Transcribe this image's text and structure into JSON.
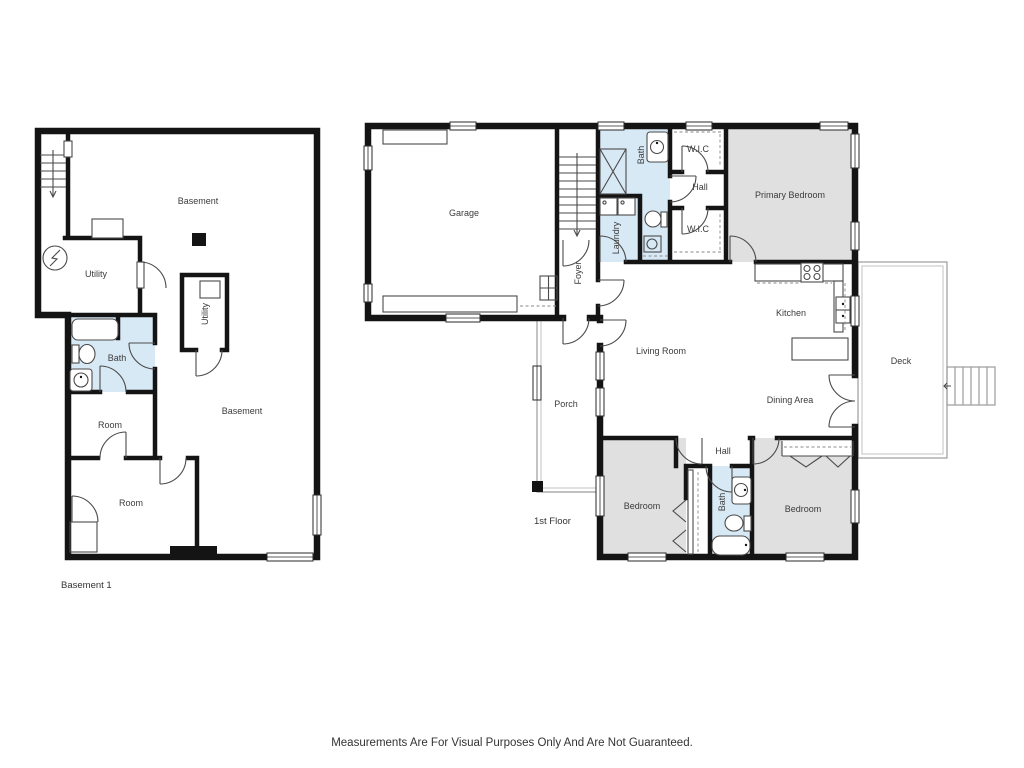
{
  "page": {
    "background": "#ffffff",
    "caption": "Measurements Are For Visual Purposes Only And Are Not Guaranteed."
  },
  "colors": {
    "wall": "#141414",
    "wet_room_fill": "#d8e9f6",
    "bedroom_fill": "#e0e0e0",
    "fixture_stroke": "#4a4a4a",
    "porch_deck_outline": "#9b9b9b",
    "label_text": "#3b3b3b"
  },
  "basement_floor": {
    "title": "Basement 1",
    "rooms": {
      "basement_main": "Basement",
      "utility": "Utility",
      "bath": "Bath",
      "utility_closet": "Utility",
      "basement_lower": "Basement",
      "room_upper": "Room",
      "room_lower": "Room"
    }
  },
  "first_floor": {
    "title": "1st Floor",
    "rooms": {
      "garage": "Garage",
      "bath_upper": "Bath",
      "wic_upper": "W.I.C",
      "hall_upper": "Hall",
      "wic_lower": "W.I.C",
      "laundry": "Laundry",
      "foyer": "Foyer",
      "primary_bedroom": "Primary Bedroom",
      "kitchen": "Kitchen",
      "living_room": "Living Room",
      "dining_area": "Dining Area",
      "deck": "Deck",
      "porch": "Porch",
      "hall_lower": "Hall",
      "bedroom_left": "Bedroom",
      "bath_lower": "Bath",
      "bedroom_right": "Bedroom"
    }
  }
}
